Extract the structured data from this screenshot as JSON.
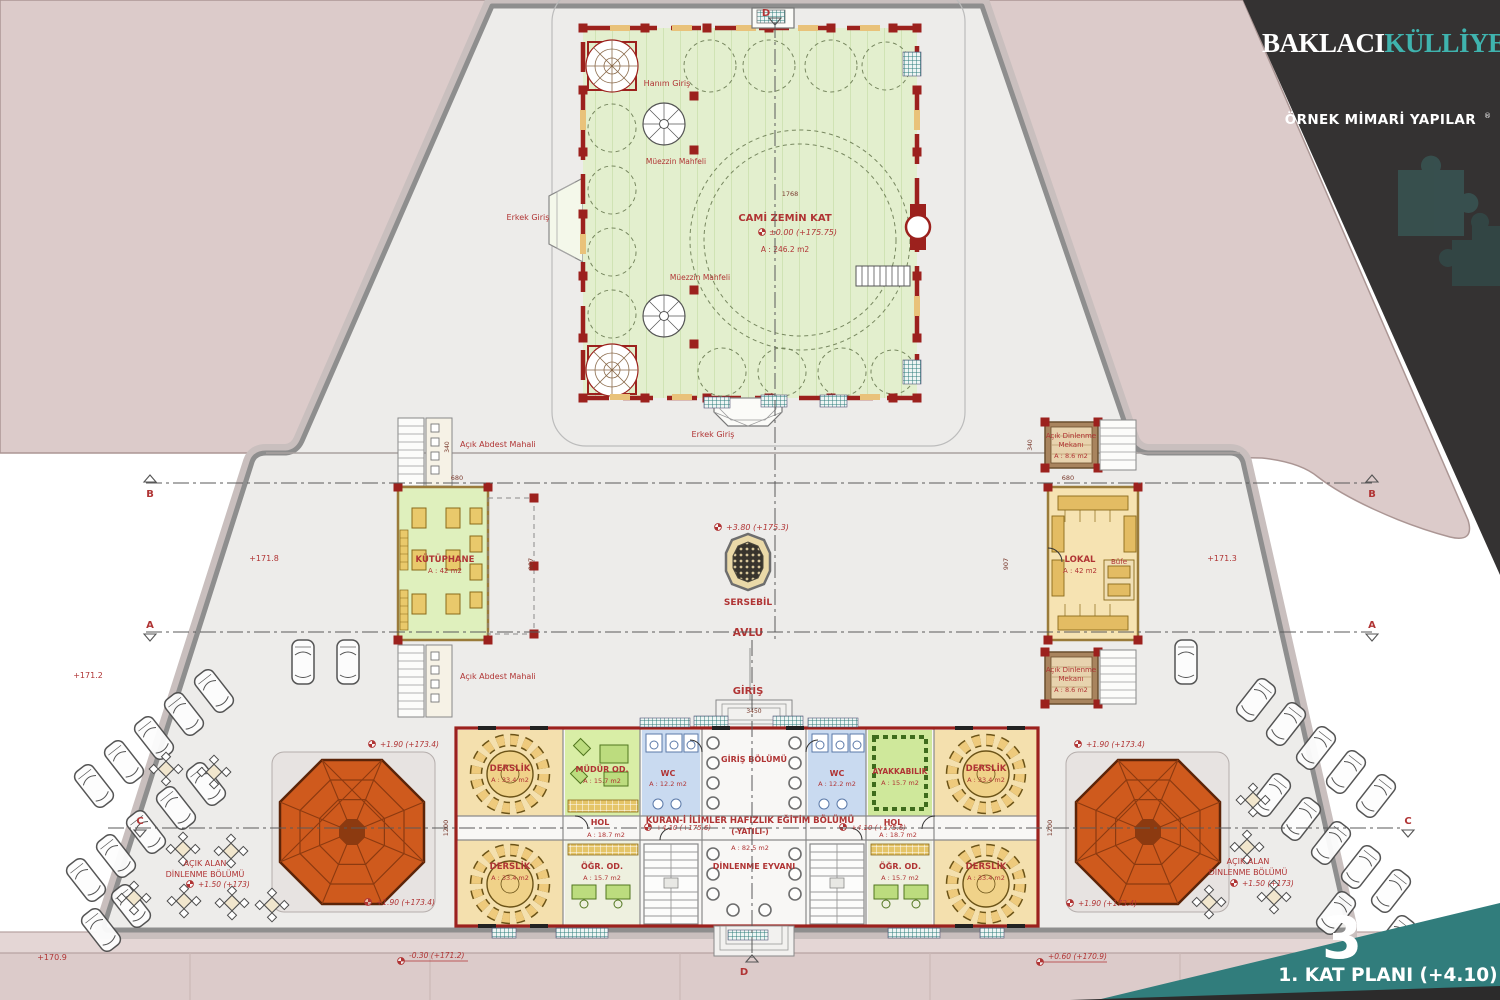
{
  "header": {
    "title_1": "BAKLACI",
    "title_2": "KÜLLİYESİ",
    "subtitle": "ÖRNEK MİMARİ YAPILAR",
    "reg": "®"
  },
  "sheet": {
    "number": "3",
    "title": "1. KAT PLANI (+4.10)"
  },
  "mosque": {
    "name": "CAMİ ZEMİN KAT",
    "elev": "±0.00 (+175.75)",
    "area": "A : 246.2 m2",
    "dim_w": "1768",
    "hanim": "Hanım Giriş",
    "erkek_left": "Erkek Giriş",
    "erkek_bottom": "Erkek Giriş",
    "muezzin_1": "Müezzin Mahfeli",
    "muezzin_2": "Müezzin Mahfeli"
  },
  "court": {
    "avlu": "AVLU",
    "giris": "GİRİŞ",
    "sersebil": "SERSEBİL",
    "elev": "+3.80 (+175.3)",
    "dim": "3450"
  },
  "library": {
    "name": "KÜTÜPHANE",
    "area": "A : 42 m2",
    "abdest_1": "Açık Abdest Mahali",
    "abdest_2": "Açık Abdest Mahali",
    "dim_w": "680",
    "dim_h": "907",
    "dim_c": "340"
  },
  "lokal": {
    "name": "LOKAL",
    "area": "A : 42 m2",
    "bufe": "Büfe",
    "rest_line1": "Açık Dinlenme",
    "rest_line2": "Mekanı",
    "rest_area": "A : 8.6 m2",
    "dim_w": "680",
    "dim_h": "907",
    "dim_c": "340"
  },
  "edu": {
    "title": "KURAN-İ İLİMLER HAFIZLIK EĞİTİM BÖLÜMÜ",
    "yatili": "(-YATILI-)",
    "area": "A : 82.5 m2",
    "hall": "GİRİŞ BÖLÜMÜ",
    "eyvan": "DİNLENME EYVANI",
    "hol": "HOL",
    "hol_area": "A : 18.7 m2",
    "elev": "+4.10 (+175.6)",
    "derslik": "DERSLİK",
    "derslik_area": "A : 33.4 m2",
    "mudur": "MÜDÜR OD.",
    "mudur_area": "A : 15.7 m2",
    "wc": "WC",
    "wc_area": "A : 12.2 m2",
    "ayak": "AYAKKABILIK",
    "ayak_area": "A : 15.7 m2",
    "ogr": "ÖĞR. OD.",
    "ogr_area": "A : 15.7 m2",
    "dim_h": "1200"
  },
  "outdoor": {
    "line1": "AÇIK ALAN",
    "line2": "DİNLENME BÖLÜMÜ",
    "elev": "+1.50 (+173)",
    "terrace": "+1.90 (+173.4)"
  },
  "site": {
    "e_left": "+171.8",
    "e_right": "+171.3",
    "e_farleft": "+171.2",
    "e_bottomleft": "+170.9",
    "e_bc_left": "-0.30 (+171.2)",
    "e_bc_right": "+0.60 (+170.9)"
  },
  "sections": {
    "a": "A",
    "b": "B",
    "c": "C",
    "d": "D"
  },
  "colors": {
    "accent_teal": "#3f948f",
    "panel_dark": "#343232",
    "plan_red": "#9c211d",
    "annotation_red": "#b03434",
    "roof_orange": "#cf5a1d",
    "mosque_green": "#e3efce",
    "room_tan": "#f4e0ae",
    "room_green": "#cfe89b",
    "room_blue": "#c9daf0",
    "site_pink": "#dccbca"
  }
}
